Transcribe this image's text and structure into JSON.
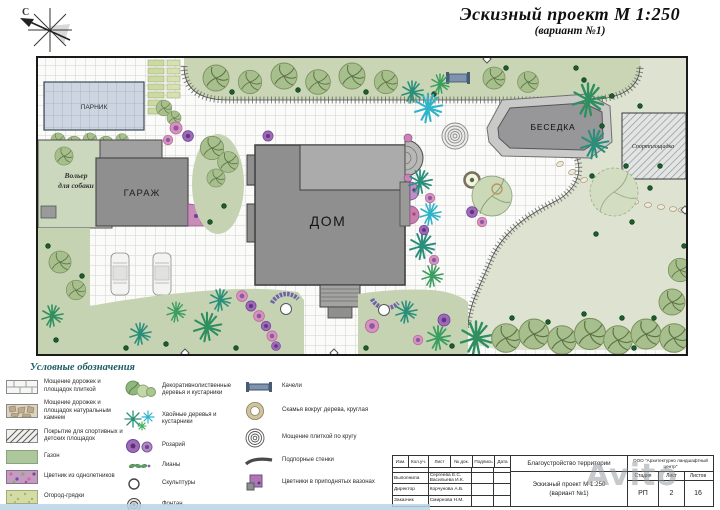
{
  "title": {
    "line1": "Эскизный проект  М 1:250",
    "line2": "(вариант  №1)"
  },
  "compass": {
    "north_label": "С"
  },
  "plan": {
    "labels": {
      "greenhouse": "ПАРНИК",
      "garage": "ГАРАЖ",
      "house": "ДОМ",
      "gazebo": "БЕСЕДКА",
      "dog_pen_1": "Вольер",
      "dog_pen_2": "для собаки",
      "sports": "Спортплощадка"
    },
    "colors": {
      "lawn": "#c6d3b2",
      "lawn_light": "#dde3d0",
      "paving_line": "#d2d2cd",
      "building": "#8f8f8f",
      "conifer_teal": "#2a8f7a",
      "conifer_cyan": "#2fb3c9",
      "flower_pink": "#d892bc",
      "flower_purple": "#9c6ab8"
    }
  },
  "legend": {
    "header": "Условные обозначения",
    "col1": [
      {
        "icon": "tile-paving-swatch",
        "label": "Мощение  дорожек и площадок плиткой"
      },
      {
        "icon": "stone-paving-swatch",
        "label": "Мощение  дорожек и площадок натуральным камнем"
      },
      {
        "icon": "sport-surface-swatch",
        "label": "Покрытие для спортивных и детских площадок"
      },
      {
        "icon": "lawn-swatch",
        "label": "Газон"
      },
      {
        "icon": "annual-flowerbed-swatch",
        "label": "Цветник из однолетников"
      },
      {
        "icon": "vegetable-beds-swatch",
        "label": "Огород-грядки"
      }
    ],
    "col2": [
      {
        "icon": "deciduous-trees-icon",
        "label": "Декоративнолиственные деревья и кустарники"
      },
      {
        "icon": "conifer-trees-icon",
        "label": "Хвойные деревья и кустарники"
      },
      {
        "icon": "rosary-icon",
        "label": "Розарий"
      },
      {
        "icon": "lianas-icon",
        "label": "Лианы"
      },
      {
        "icon": "sculptures-icon",
        "label": "Скульптуры"
      },
      {
        "icon": "fountain-icon",
        "label": "Фонтан"
      }
    ],
    "col3": [
      {
        "icon": "swing-icon",
        "label": "Качели"
      },
      {
        "icon": "round-bench-icon",
        "label": "Скамья вокруг дерева, круглая"
      },
      {
        "icon": "circular-paving-icon",
        "label": "Мощение плиткой по кругу"
      },
      {
        "icon": "retaining-walls-icon",
        "label": "Подпорные стенки"
      },
      {
        "icon": "raised-planters-icon",
        "label": "Цветники в приподнятых вазонах"
      }
    ]
  },
  "titleblock": {
    "cols": {
      "izm": "Изм.",
      "kol": "Кол.уч.",
      "list": "Лист",
      "ndok": "№ док.",
      "podp": "Подпись",
      "data": "Дата"
    },
    "rows": [
      {
        "role": "Выполнила",
        "name": "Сергеева Е.С. Васильева И.К."
      },
      {
        "role": "Директор",
        "name": "Корчунова А.Б."
      },
      {
        "role": "Заказчик",
        "name": "Смирнова Н.М."
      }
    ],
    "project": "Благоустройство  территории",
    "drawing_title": "Эскизный проект  М 1:250",
    "drawing_variant": "(вариант  №1)",
    "company": "ООО \"Архитектурно ландшафтный центр\"",
    "stage": {
      "h1": "Стадия",
      "h2": "Лист",
      "h3": "Листов",
      "v1": "РП",
      "v2": "2",
      "v3": "16"
    }
  },
  "watermark": "Avito"
}
